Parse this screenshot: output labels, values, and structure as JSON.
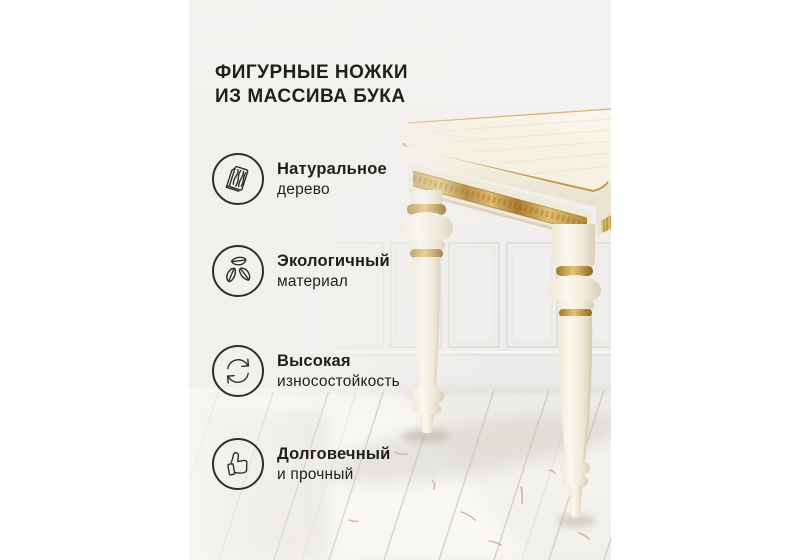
{
  "card": {
    "title_line1": "ФИГУРНЫЕ НОЖКИ",
    "title_line2": "ИЗ МАССИВА БУКА",
    "features": [
      {
        "icon": "wood-plank-icon",
        "line1": "Натуральное",
        "line2": "дерево"
      },
      {
        "icon": "eco-leaves-icon",
        "line1": "Экологичный",
        "line2": "материал"
      },
      {
        "icon": "wear-refresh-icon",
        "line1": "Высокая",
        "line2": "износостойкость"
      },
      {
        "icon": "thumbs-up-icon",
        "line1": "Долговечный",
        "line2": "и прочный"
      }
    ],
    "palette": {
      "page_background": "#ffffff",
      "card_background": "#f2f1ee",
      "text": "#201f1b",
      "icon_stroke": "#2e2d29",
      "table_cream": "#f4efe2",
      "gold_accent": "#c29a4a",
      "wall": "#f1f0ee",
      "floor": "#f4f2ee"
    }
  }
}
